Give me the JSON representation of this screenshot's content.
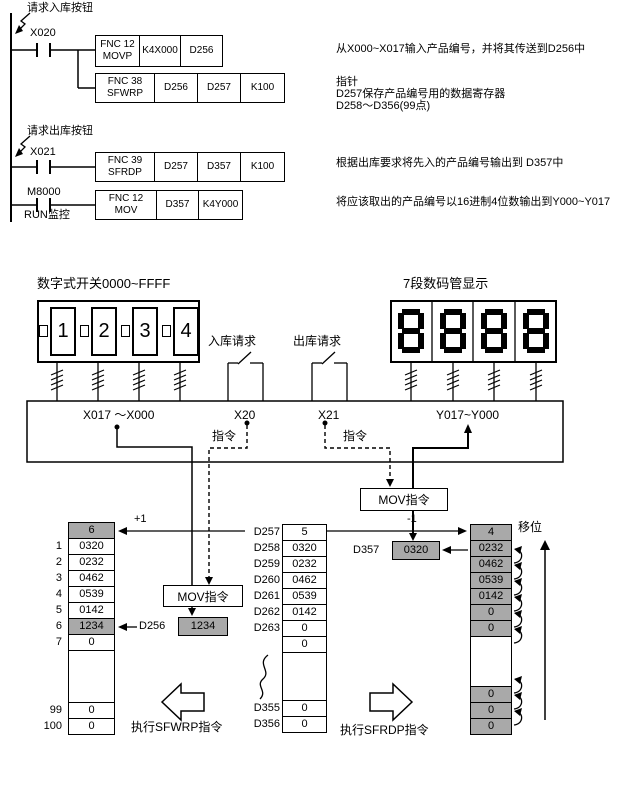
{
  "ladder": {
    "comment_in": "请求入库按钮",
    "comment_out": "请求出库按钮",
    "contact1": "X020",
    "contact2": "X021",
    "contact3": "M8000",
    "run_monitor": "RUN监控",
    "box1": {
      "fnc": "FNC 12",
      "name": "MOVP",
      "op1": "K4X000",
      "op2": "D256"
    },
    "box2": {
      "fnc": "FNC 38",
      "name": "SFWRP",
      "op1": "D256",
      "op2": "D257",
      "op3": "K100"
    },
    "box3": {
      "fnc": "FNC 39",
      "name": "SFRDP",
      "op1": "D257",
      "op2": "D357",
      "op3": "K100"
    },
    "box4": {
      "fnc": "FNC 12",
      "name": "MOV",
      "op1": "D357",
      "op2": "K4Y000"
    },
    "anno1": "从X000~X017输入产品编号，并将其传送到D256中",
    "anno2": "指针",
    "anno3": "D257保存产品编号用的数据寄存器",
    "anno4": "D258～D356(99点)",
    "anno5": "根据出库要求将先入的产品编号输出到 D357中",
    "anno6": "将应该取出的产品编号以16进制4位数输出到Y000~Y017"
  },
  "hardware": {
    "switch_title": "数字式开关0000~FFFF",
    "digits": [
      "1",
      "2",
      "3",
      "4"
    ],
    "display_title": "7段数码管显示",
    "display_value": "8888",
    "request_in": "入库请求",
    "request_out": "出库请求"
  },
  "bus": {
    "x_range": "X017 ～X000",
    "x20": "X20",
    "x21": "X21",
    "y_range": "Y017~Y000",
    "cmd1": "指令",
    "cmd2": "指令"
  },
  "flow": {
    "mov1": "MOV指令",
    "mov2": "MOV指令",
    "plus_one": "+1",
    "minus_one": "-1",
    "shift": "移位",
    "d256_label": "D256",
    "d256_value": "1234",
    "d357_label": "D357",
    "d357_value": "0320",
    "exec_left": "执行SFWRP指令",
    "exec_right": "执行SFRDP指令"
  },
  "tables": {
    "left": {
      "pointer": "6",
      "rows": [
        {
          "n": "1",
          "v": "0320"
        },
        {
          "n": "2",
          "v": "0232"
        },
        {
          "n": "3",
          "v": "0462"
        },
        {
          "n": "4",
          "v": "0539"
        },
        {
          "n": "5",
          "v": "0142"
        },
        {
          "n": "6",
          "v": "1234"
        },
        {
          "n": "7",
          "v": "0"
        }
      ],
      "tail": [
        {
          "n": "99",
          "v": "0"
        },
        {
          "n": "100",
          "v": "0"
        }
      ]
    },
    "middle": {
      "rows": [
        {
          "n": "D257",
          "v": "5"
        },
        {
          "n": "D258",
          "v": "0320"
        },
        {
          "n": "D259",
          "v": "0232"
        },
        {
          "n": "D260",
          "v": "0462"
        },
        {
          "n": "D261",
          "v": "0539"
        },
        {
          "n": "D262",
          "v": "0142"
        },
        {
          "n": "D263",
          "v": "0"
        },
        {
          "n": "",
          "v": "0"
        }
      ],
      "tail": [
        {
          "n": "D355",
          "v": "0"
        },
        {
          "n": "D356",
          "v": "0"
        }
      ]
    },
    "right": {
      "pointer": "4",
      "values": [
        "0232",
        "0462",
        "0539",
        "0142",
        "0",
        "0"
      ],
      "tail": [
        "0",
        "0",
        "0"
      ]
    }
  },
  "colors": {
    "highlight": "#a9a9a9",
    "line": "#000000",
    "background": "#ffffff"
  }
}
